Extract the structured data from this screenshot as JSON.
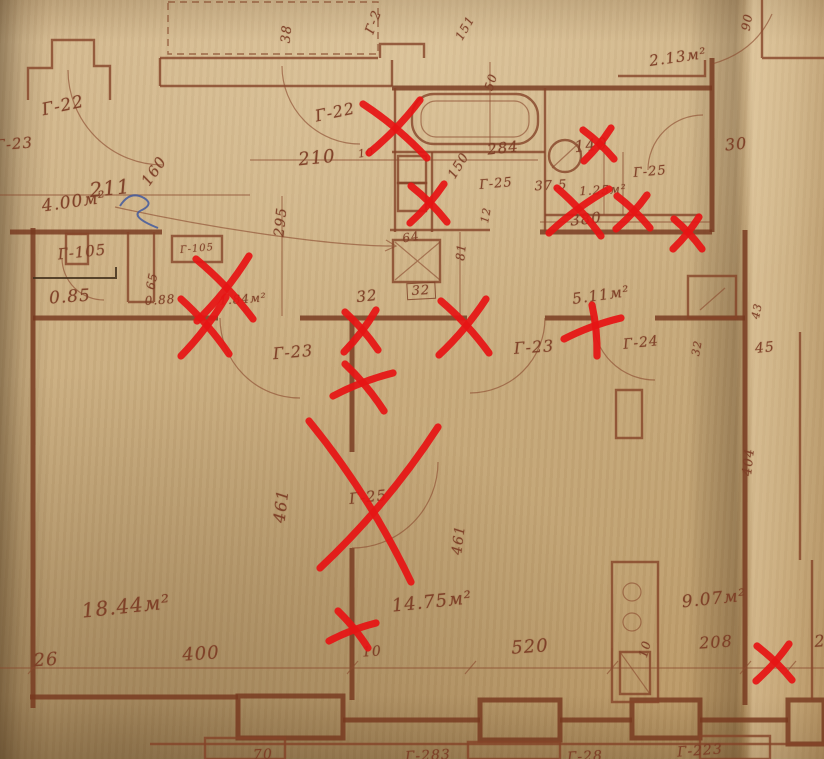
{
  "colors": {
    "paper": "#c9ac7e",
    "ink": "#8a4a33",
    "ink_dark": "#6f3a24",
    "annotation_red": "#e61414",
    "pen_blue": "#3a55a0"
  },
  "plan_labels": [
    {
      "text": "Г-22",
      "x": 63,
      "y": 106,
      "rot": -12,
      "size": 17
    },
    {
      "text": "Г-23",
      "x": 14,
      "y": 144,
      "rot": -5,
      "size": 15
    },
    {
      "text": "211",
      "x": 110,
      "y": 188,
      "rot": -6,
      "size": 20
    },
    {
      "text": "160",
      "x": 154,
      "y": 171,
      "rot": -55,
      "size": 15
    },
    {
      "text": "4.00м²",
      "x": 74,
      "y": 202,
      "rot": -8,
      "size": 17
    },
    {
      "text": "Г-22",
      "x": 335,
      "y": 112,
      "rot": -12,
      "size": 16
    },
    {
      "text": "210",
      "x": 317,
      "y": 158,
      "rot": -6,
      "size": 18
    },
    {
      "text": "10",
      "x": 366,
      "y": 153,
      "rot": -8,
      "size": 11
    },
    {
      "text": "150",
      "x": 459,
      "y": 166,
      "rot": -58,
      "size": 13
    },
    {
      "text": "284",
      "x": 503,
      "y": 148,
      "rot": -6,
      "size": 15
    },
    {
      "text": "Г-25",
      "x": 496,
      "y": 184,
      "rot": -5,
      "size": 13
    },
    {
      "text": "37.5",
      "x": 551,
      "y": 186,
      "rot": -3,
      "size": 13
    },
    {
      "text": "1.25м²",
      "x": 603,
      "y": 190,
      "rot": -3,
      "size": 12
    },
    {
      "text": "Г-25",
      "x": 650,
      "y": 172,
      "rot": -5,
      "size": 13
    },
    {
      "text": "140",
      "x": 591,
      "y": 145,
      "rot": -6,
      "size": 16
    },
    {
      "text": "30",
      "x": 736,
      "y": 144,
      "rot": -6,
      "size": 16
    },
    {
      "text": "380",
      "x": 586,
      "y": 219,
      "rot": -6,
      "size": 15
    },
    {
      "text": "2.13м²",
      "x": 678,
      "y": 57,
      "rot": -8,
      "size": 15
    },
    {
      "text": "38",
      "x": 287,
      "y": 34,
      "rot": -85,
      "size": 13
    },
    {
      "text": "Г-2",
      "x": 374,
      "y": 22,
      "rot": -70,
      "size": 13
    },
    {
      "text": "151",
      "x": 465,
      "y": 28,
      "rot": -60,
      "size": 12
    },
    {
      "text": "50",
      "x": 491,
      "y": 82,
      "rot": -72,
      "size": 12
    },
    {
      "text": "90",
      "x": 747,
      "y": 22,
      "rot": -80,
      "size": 12
    },
    {
      "text": "Г-105",
      "x": 82,
      "y": 252,
      "rot": -6,
      "size": 15
    },
    {
      "text": "0.85",
      "x": 70,
      "y": 297,
      "rot": -4,
      "size": 17
    },
    {
      "text": "65",
      "x": 152,
      "y": 281,
      "rot": -78,
      "size": 12
    },
    {
      "text": "Г-105",
      "x": 197,
      "y": 249,
      "rot": -5,
      "size": 10
    },
    {
      "text": "0.88",
      "x": 160,
      "y": 300,
      "rot": -4,
      "size": 12
    },
    {
      "text": "1.84м²",
      "x": 243,
      "y": 299,
      "rot": -4,
      "size": 12
    },
    {
      "text": "295",
      "x": 281,
      "y": 222,
      "rot": -84,
      "size": 14
    },
    {
      "text": "32",
      "x": 367,
      "y": 296,
      "rot": -6,
      "size": 15
    },
    {
      "text": "32",
      "x": 421,
      "y": 291,
      "rot": -3,
      "size": 13,
      "boxed": true
    },
    {
      "text": "64",
      "x": 411,
      "y": 237,
      "rot": -10,
      "size": 12
    },
    {
      "text": "81",
      "x": 461,
      "y": 252,
      "rot": -84,
      "size": 12
    },
    {
      "text": "12",
      "x": 486,
      "y": 215,
      "rot": -80,
      "size": 11
    },
    {
      "text": "Г-23",
      "x": 293,
      "y": 352,
      "rot": -5,
      "size": 16
    },
    {
      "text": "Г-23",
      "x": 534,
      "y": 347,
      "rot": -4,
      "size": 16
    },
    {
      "text": "Г-24",
      "x": 641,
      "y": 343,
      "rot": -6,
      "size": 14
    },
    {
      "text": "32",
      "x": 697,
      "y": 348,
      "rot": -80,
      "size": 11
    },
    {
      "text": "45",
      "x": 765,
      "y": 348,
      "rot": -6,
      "size": 14
    },
    {
      "text": "43",
      "x": 757,
      "y": 311,
      "rot": -78,
      "size": 11
    },
    {
      "text": "5.11м²",
      "x": 601,
      "y": 295,
      "rot": -8,
      "size": 15
    },
    {
      "text": "461",
      "x": 281,
      "y": 506,
      "rot": -83,
      "size": 16
    },
    {
      "text": "461",
      "x": 459,
      "y": 540,
      "rot": -83,
      "size": 14
    },
    {
      "text": "Г-25",
      "x": 368,
      "y": 497,
      "rot": -6,
      "size": 15
    },
    {
      "text": "404",
      "x": 749,
      "y": 462,
      "rot": -84,
      "size": 13
    },
    {
      "text": "18.44м²",
      "x": 126,
      "y": 606,
      "rot": -6,
      "size": 20
    },
    {
      "text": "26",
      "x": 46,
      "y": 660,
      "rot": -4,
      "size": 18
    },
    {
      "text": "400",
      "x": 201,
      "y": 654,
      "rot": -4,
      "size": 18
    },
    {
      "text": "14.75м²",
      "x": 432,
      "y": 602,
      "rot": -6,
      "size": 18
    },
    {
      "text": "10",
      "x": 372,
      "y": 652,
      "rot": -4,
      "size": 14
    },
    {
      "text": "520",
      "x": 530,
      "y": 647,
      "rot": -4,
      "size": 18
    },
    {
      "text": "9.07м²",
      "x": 714,
      "y": 599,
      "rot": -6,
      "size": 17
    },
    {
      "text": "10",
      "x": 645,
      "y": 649,
      "rot": -75,
      "size": 12
    },
    {
      "text": "208",
      "x": 716,
      "y": 642,
      "rot": -4,
      "size": 16
    },
    {
      "text": "2",
      "x": 820,
      "y": 641,
      "rot": -4,
      "size": 16
    },
    {
      "text": "70",
      "x": 263,
      "y": 755,
      "rot": -3,
      "size": 14
    },
    {
      "text": "Г-283",
      "x": 428,
      "y": 756,
      "rot": -3,
      "size": 14
    },
    {
      "text": "Г-28",
      "x": 585,
      "y": 757,
      "rot": -3,
      "size": 14
    },
    {
      "text": "Г-223",
      "x": 700,
      "y": 751,
      "rot": -4,
      "size": 14
    }
  ],
  "red_marks": [
    {
      "strokes": [
        [
          363,
          104,
          427,
          158
        ],
        [
          420,
          100,
          369,
          153
        ]
      ]
    },
    {
      "strokes": [
        [
          583,
          130,
          614,
          159
        ],
        [
          611,
          128,
          584,
          161
        ]
      ]
    },
    {
      "strokes": [
        [
          411,
          186,
          447,
          222
        ],
        [
          444,
          184,
          410,
          223
        ]
      ]
    },
    {
      "strokes": [
        [
          549,
          233,
          609,
          189
        ],
        [
          557,
          188,
          601,
          236
        ]
      ]
    },
    {
      "strokes": [
        [
          617,
          196,
          650,
          228
        ],
        [
          647,
          195,
          616,
          229
        ]
      ]
    },
    {
      "strokes": [
        [
          674,
          219,
          702,
          249
        ],
        [
          699,
          217,
          673,
          249
        ]
      ]
    },
    {
      "strokes": [
        [
          196,
          259,
          253,
          319
        ],
        [
          249,
          256,
          197,
          321
        ]
      ]
    },
    {
      "strokes": [
        [
          181,
          299,
          229,
          354
        ],
        [
          226,
          297,
          181,
          356
        ]
      ]
    },
    {
      "strokes": [
        [
          345,
          312,
          378,
          350
        ],
        [
          376,
          310,
          344,
          352
        ]
      ]
    },
    {
      "strokes": [
        [
          441,
          301,
          489,
          353
        ],
        [
          486,
          299,
          439,
          355
        ]
      ]
    },
    {
      "strokes": [
        [
          592,
          305,
          597,
          356
        ],
        [
          564,
          339,
          621,
          318
        ]
      ]
    },
    {
      "strokes": [
        [
          333,
          396,
          393,
          373
        ],
        [
          345,
          364,
          384,
          411
        ]
      ]
    },
    {
      "strokes": [
        [
          309,
          421,
          411,
          582
        ],
        [
          438,
          427,
          320,
          568
        ]
      ]
    },
    {
      "strokes": [
        [
          338,
          611,
          368,
          648
        ],
        [
          329,
          641,
          376,
          623
        ]
      ]
    },
    {
      "strokes": [
        [
          757,
          646,
          792,
          680
        ],
        [
          789,
          644,
          756,
          681
        ]
      ]
    }
  ]
}
